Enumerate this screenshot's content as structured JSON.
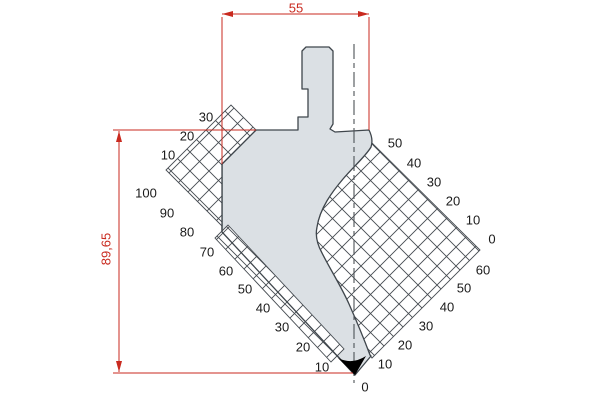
{
  "title": "Press brake punch profile drawing",
  "dimensions": {
    "width_label": "55",
    "height_label": "89,65"
  },
  "scales": {
    "left_upper": [
      "30",
      "20",
      "10"
    ],
    "left_lower": [
      "100",
      "90",
      "80",
      "70",
      "60",
      "50",
      "40",
      "30",
      "20",
      "10"
    ],
    "right_upper": [
      "50",
      "40",
      "30",
      "20",
      "10",
      "0"
    ],
    "right_lower": [
      "60",
      "50",
      "40",
      "30",
      "20",
      "10",
      "0"
    ]
  },
  "colors": {
    "dimension": "#c92a1f",
    "body_fill": "#dbe0e4",
    "outline": "#3f464c",
    "hatch_line": "#454b51",
    "centerline": "#4d5257",
    "tip": "#000000",
    "label_text": "#1b1b1b"
  }
}
